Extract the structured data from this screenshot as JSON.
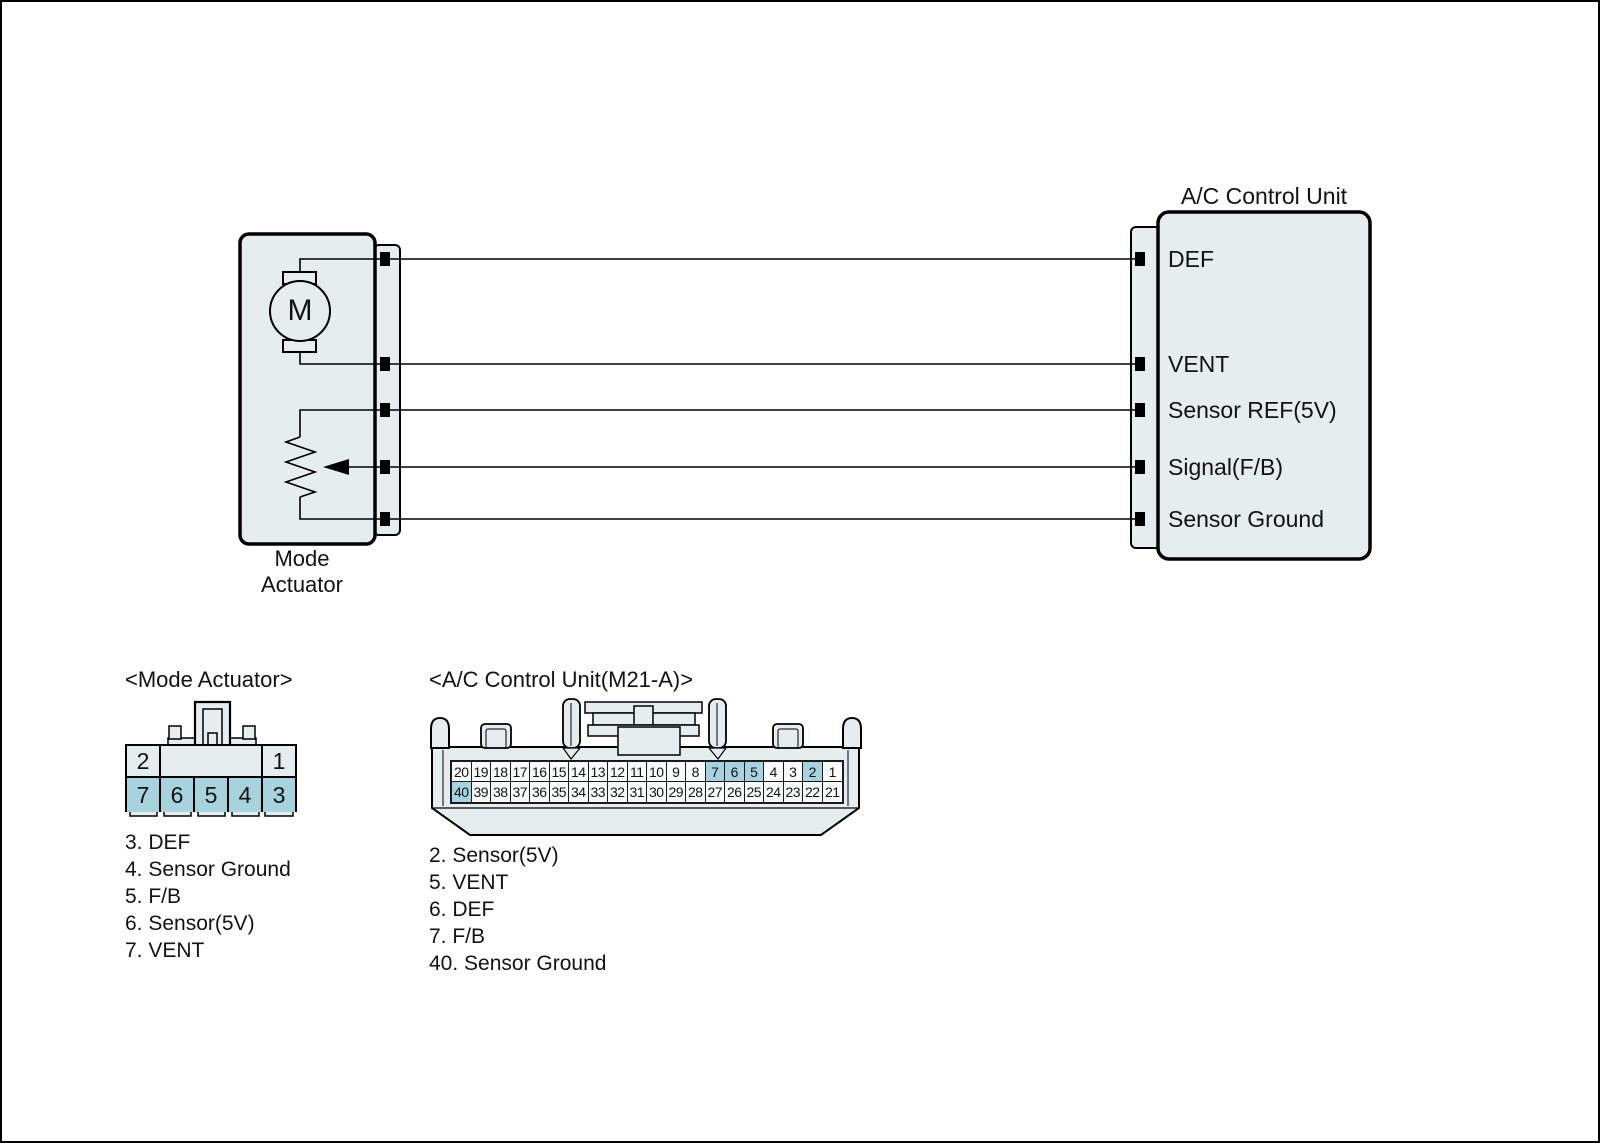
{
  "colors": {
    "panel_fill": "#e6edee",
    "highlight": "#a6d3dd",
    "cell_bg": "#fafcfc",
    "line": "#000000"
  },
  "wiring": {
    "actuator_caption": [
      "Mode",
      "Actuator"
    ],
    "motor_label": "M",
    "control_unit_title": "A/C Control Unit",
    "control_unit_pins": [
      "DEF",
      "VENT",
      "Sensor REF(5V)",
      "Signal(F/B)",
      "Sensor Ground"
    ]
  },
  "mode_connector": {
    "title": "<Mode Actuator>",
    "pin2": "2",
    "pin1": "1",
    "bottom_row": [
      {
        "n": "7",
        "hl": true
      },
      {
        "n": "6",
        "hl": true
      },
      {
        "n": "5",
        "hl": true
      },
      {
        "n": "4",
        "hl": true
      },
      {
        "n": "3",
        "hl": true
      }
    ],
    "legend": [
      "3. DEF",
      "4. Sensor Ground",
      "5. F/B",
      "6. Sensor(5V)",
      "7. VENT"
    ]
  },
  "ac_connector": {
    "title": "<A/C Control Unit(M21-A)>",
    "top_row": [
      {
        "n": "20"
      },
      {
        "n": "19"
      },
      {
        "n": "18"
      },
      {
        "n": "17"
      },
      {
        "n": "16"
      },
      {
        "n": "15"
      },
      {
        "n": "14"
      },
      {
        "n": "13"
      },
      {
        "n": "12"
      },
      {
        "n": "11"
      },
      {
        "n": "10"
      },
      {
        "n": "9"
      },
      {
        "n": "8"
      },
      {
        "n": "7",
        "hl": true
      },
      {
        "n": "6",
        "hl": true
      },
      {
        "n": "5",
        "hl": true
      },
      {
        "n": "4"
      },
      {
        "n": "3"
      },
      {
        "n": "2",
        "hl": true
      },
      {
        "n": "1"
      }
    ],
    "bottom_row": [
      {
        "n": "40",
        "hl": true
      },
      {
        "n": "39"
      },
      {
        "n": "38"
      },
      {
        "n": "37"
      },
      {
        "n": "36"
      },
      {
        "n": "35"
      },
      {
        "n": "34"
      },
      {
        "n": "33"
      },
      {
        "n": "32"
      },
      {
        "n": "31"
      },
      {
        "n": "30"
      },
      {
        "n": "29"
      },
      {
        "n": "28"
      },
      {
        "n": "27"
      },
      {
        "n": "26"
      },
      {
        "n": "25"
      },
      {
        "n": "24"
      },
      {
        "n": "23"
      },
      {
        "n": "22"
      },
      {
        "n": "21"
      }
    ],
    "legend": [
      "2. Sensor(5V)",
      "5. VENT",
      "6. DEF",
      "7. F/B",
      "40. Sensor Ground"
    ]
  }
}
